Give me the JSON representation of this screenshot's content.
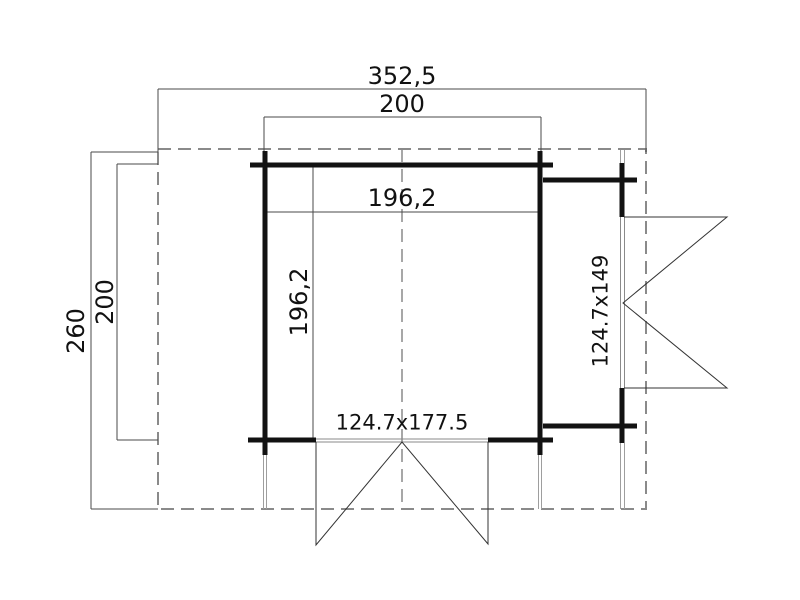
{
  "drawing": {
    "dimensions": {
      "overall_width": "352,5",
      "outer_width": "200",
      "inner_width": "196,2",
      "inner_depth": "196,2",
      "overall_depth": "260",
      "outer_depth": "200"
    },
    "doors": {
      "front_door_size": "124.7x177.5",
      "side_door_size": "124.7x149"
    },
    "colors": {
      "background": "#ffffff",
      "wall": "#121212",
      "dimension_line": "#4a4a4a",
      "door_swing_line": "#333333",
      "dashed_outline": "#8a8a8a",
      "door_frame_line": "#8a8a8a",
      "post_stub_line": "#9e9e9e",
      "text": "#111111"
    }
  }
}
